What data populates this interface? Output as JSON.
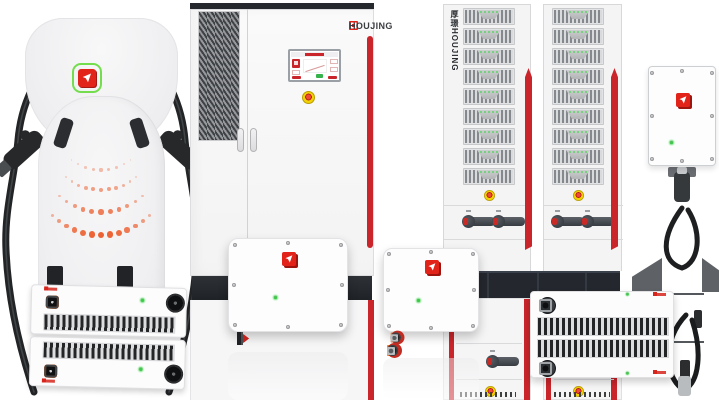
{
  "brand": {
    "wordmark": "HOUJING",
    "vertical_wordmark": "厚璟HOUJING",
    "logo_red": "#e2231a",
    "logo_green_ring": "#74dd4e"
  },
  "colors": {
    "accent_red": "#c9252b",
    "estop_yellow": "#f2d203",
    "estop_red": "#c4201a",
    "led_green": "#3fc94a",
    "connector_orange": "#ee6a24",
    "cable_black": "#26282a",
    "dot_orange": "#ed6233",
    "cabinet_dark": "#25282c"
  },
  "charger": {
    "dot_arcs": [
      {
        "cx": 101,
        "cy": 122,
        "r": 48,
        "start": 52,
        "end": 128,
        "count": 9,
        "min_size": 1.4,
        "max_size": 3.2,
        "base_opacity": 0.4
      },
      {
        "cx": 101,
        "cy": 135,
        "r": 55,
        "start": 50,
        "end": 130,
        "count": 11,
        "min_size": 2.0,
        "max_size": 4.2,
        "base_opacity": 0.6
      },
      {
        "cx": 101,
        "cy": 150,
        "r": 62,
        "start": 48,
        "end": 132,
        "count": 11,
        "min_size": 2.6,
        "max_size": 5.2,
        "base_opacity": 0.8
      },
      {
        "cx": 101,
        "cy": 165,
        "r": 70,
        "start": 46,
        "end": 134,
        "count": 13,
        "min_size": 3.2,
        "max_size": 6.4,
        "base_opacity": 1
      }
    ]
  },
  "rack": {
    "module_rows": 9,
    "leds_per_module": 5,
    "rack_count": 2
  },
  "leds": {
    "cols": 4
  },
  "screws": {
    "positions": [
      [
        5,
        6
      ],
      [
        50,
        4
      ],
      [
        95,
        6
      ],
      [
        4,
        50
      ],
      [
        96,
        50
      ],
      [
        5,
        94
      ],
      [
        50,
        96
      ],
      [
        95,
        94
      ]
    ]
  },
  "connector_rows": {
    "rectifier": [
      "orange",
      "orange",
      "orange",
      "orange",
      "gap",
      "orange",
      "black"
    ],
    "box1": [
      "orange-sm",
      "bk",
      "bk",
      "bk",
      "red-chevron",
      "bk",
      "bk",
      "bk",
      "red-chevron",
      "bk",
      "bk"
    ],
    "box2": [
      "orange-square",
      "red-disc",
      "gland",
      "gland",
      "gland",
      "silver"
    ],
    "wide": [
      "orange",
      "black",
      "orange",
      "black",
      "gap",
      "knob",
      "gap",
      "round-brown",
      "round",
      "round",
      "socket"
    ]
  }
}
